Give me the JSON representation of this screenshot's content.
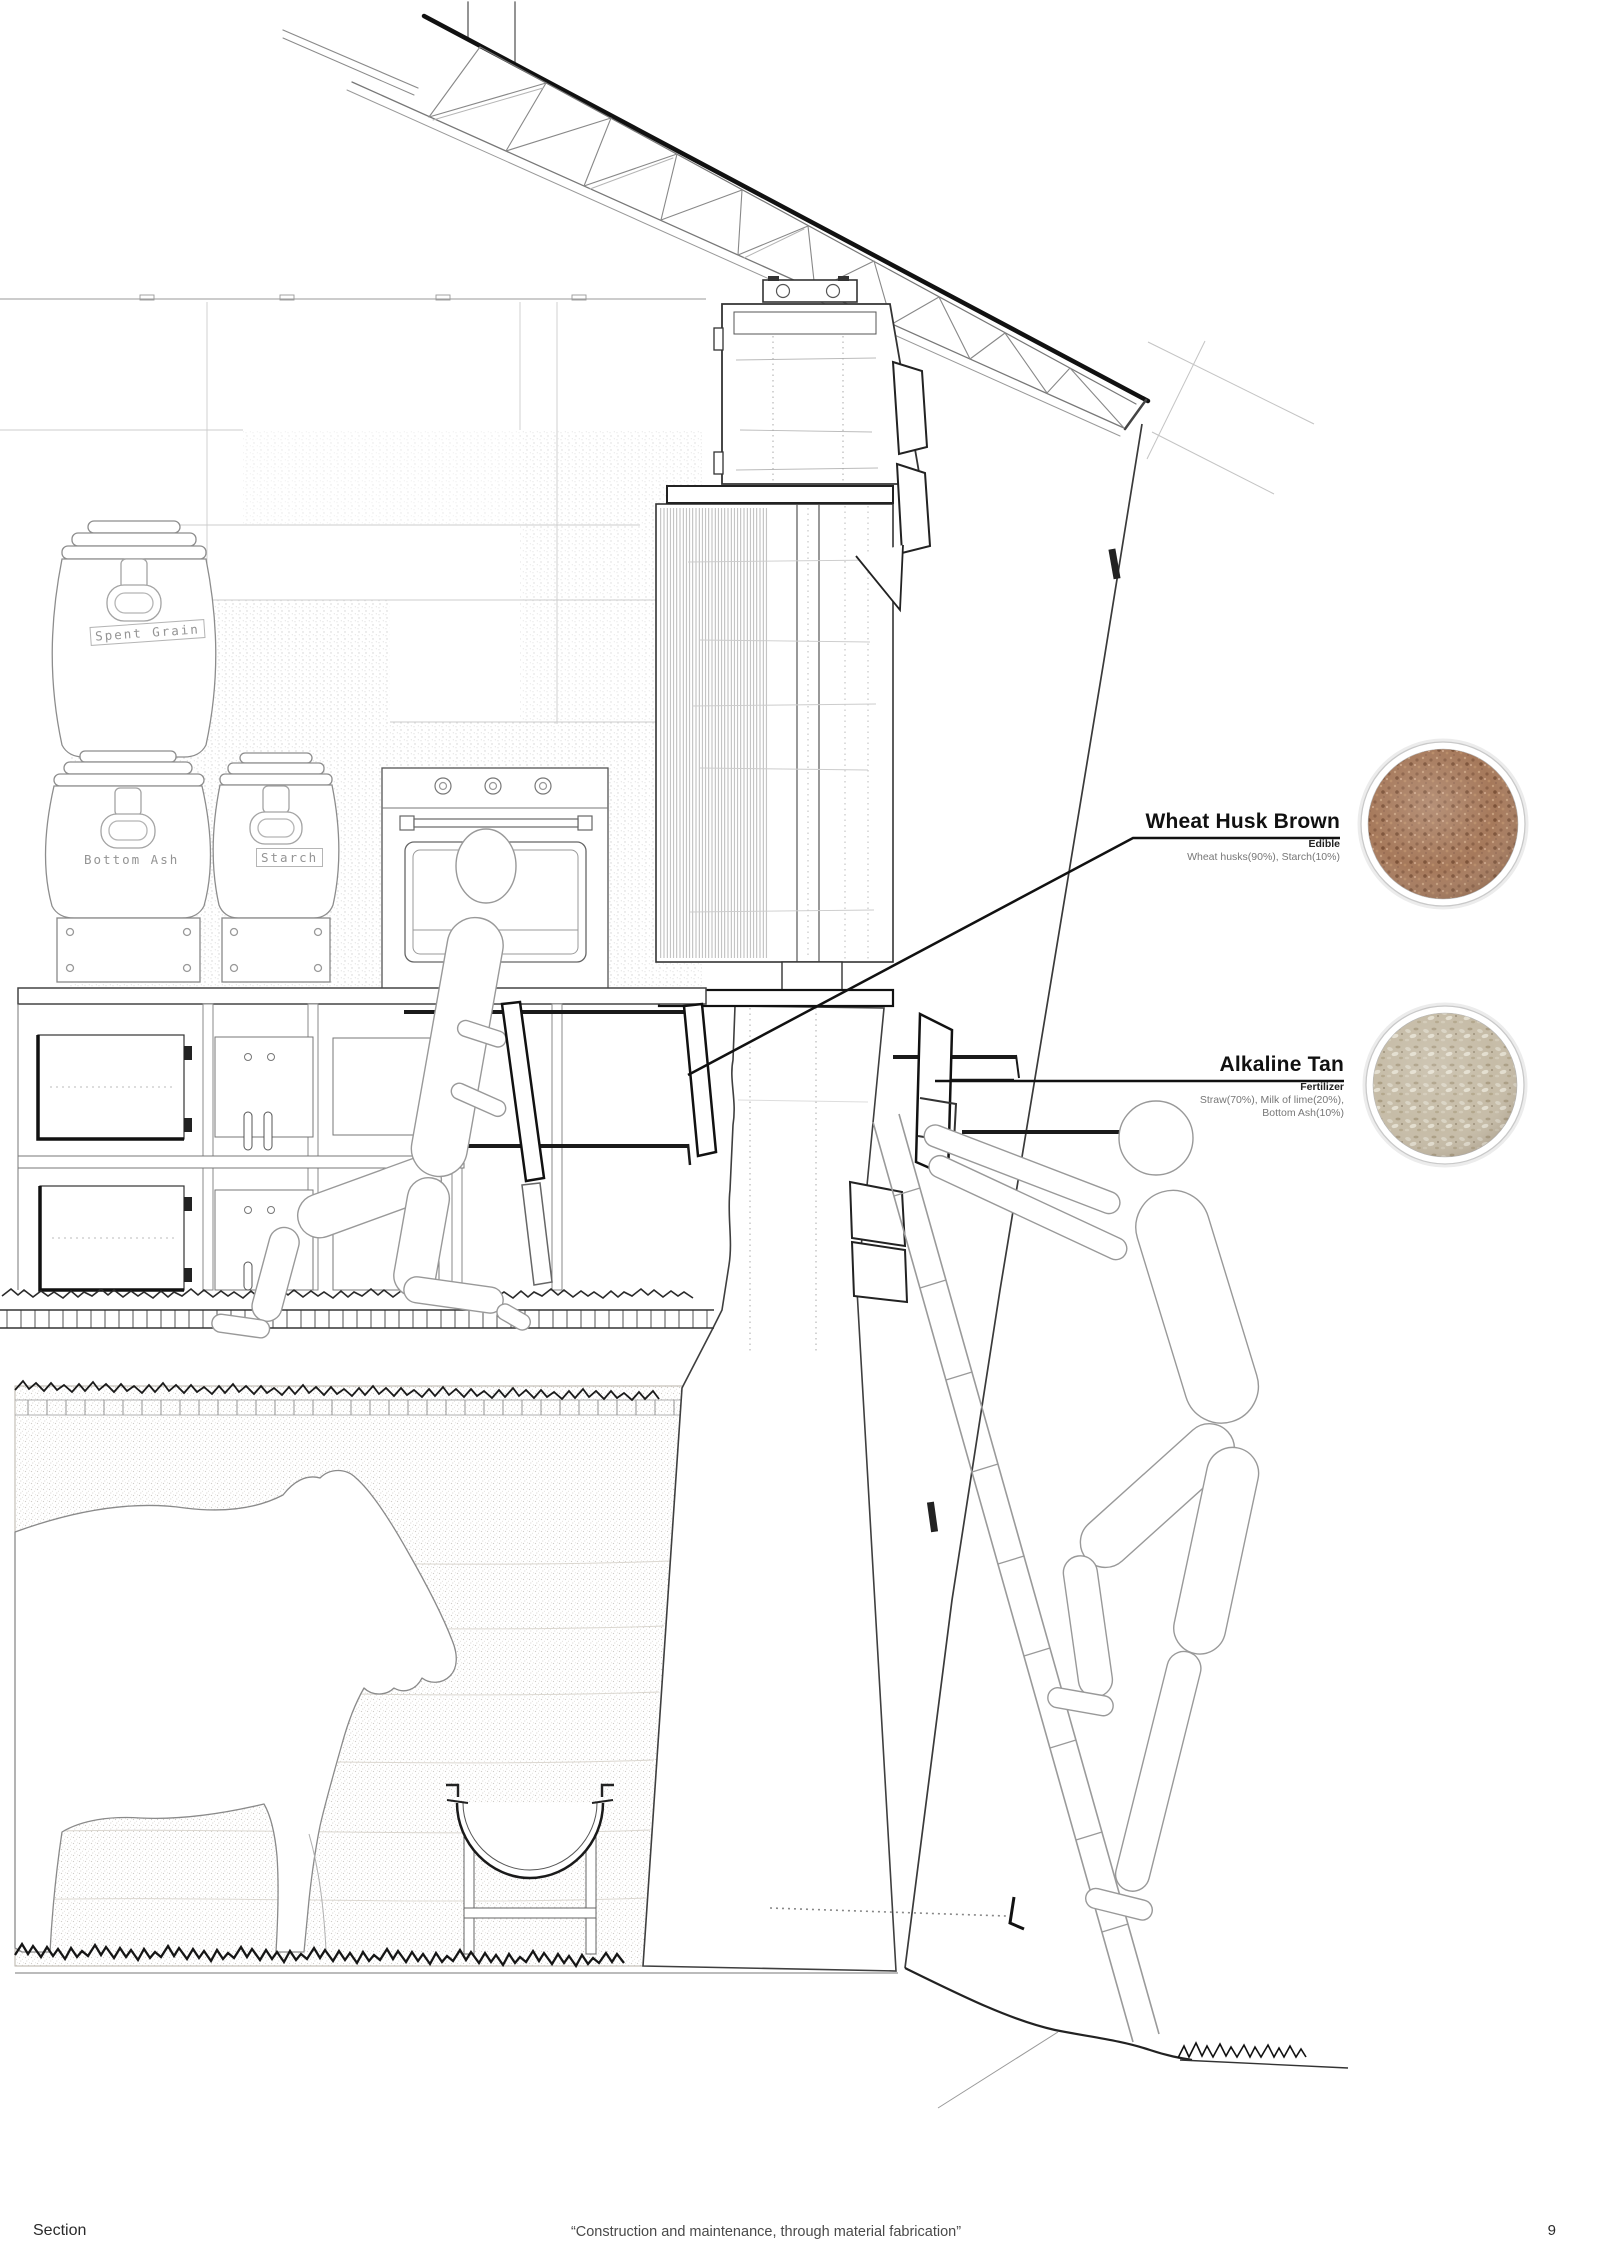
{
  "sheet": {
    "materials": [
      {
        "name": "Wheat Husk Brown",
        "category": "Edible",
        "composition": [
          "Wheat husks(90%), Starch(10%)"
        ],
        "swatch_color": "#a6795b"
      },
      {
        "name": "Alkaline Tan",
        "category": "Fertilizer",
        "composition": [
          "Straw(70%), Milk of lime(20%),",
          "Bottom Ash(10%)"
        ],
        "swatch_color": "#c3b9a4"
      }
    ],
    "barrel_labels": [
      "Spent Grain",
      "Bottom Ash",
      "Starch"
    ],
    "footer": {
      "left": "Section",
      "center": "“Construction and maintenance, through material fabrication”",
      "page_number": "9"
    }
  }
}
